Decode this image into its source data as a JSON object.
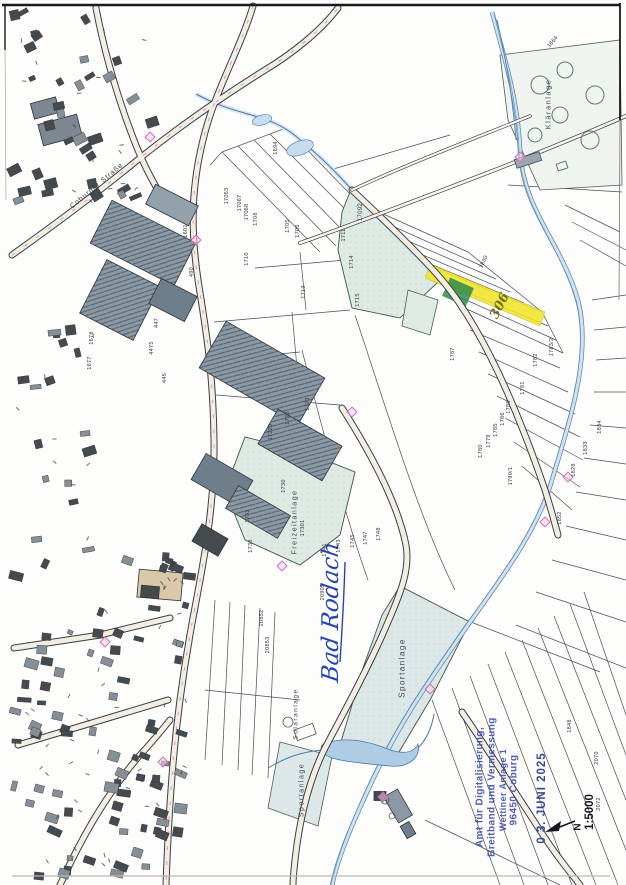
{
  "page": {
    "background": "#fdfdfc"
  },
  "stamp": {
    "office_lines": [
      "Amt für Digitalisierung,",
      "Breitband und Vermessung",
      "Wettiner Anlage 1",
      "96450 Coburg"
    ],
    "date_stamp": "0 3. JUNI 2025",
    "scale_label": "1:5000",
    "north_label": "N",
    "ink_color": "#4352b0"
  },
  "annotations": {
    "handwritten_place": "Bad Rodach",
    "handwritten_parcel": "306",
    "ink_color": "#2644b8",
    "highlight_color": "#f2e428",
    "marker_color": "#2e8b4f"
  },
  "labels": {
    "street": "Coburger Straße",
    "klaeranlage": "Kläranlage",
    "sportanlage_1": "Sportanlage",
    "freizeitanlage": "Freizeitanlage",
    "solaranlage": "Solaranlage",
    "sportanlage_2": "Sportanlage"
  },
  "parcel_numbers": [
    {
      "t": "1694",
      "x": 276,
      "y": 148
    },
    {
      "t": "1601",
      "x": 186,
      "y": 231
    },
    {
      "t": "17063",
      "x": 227,
      "y": 196
    },
    {
      "t": "17067",
      "x": 240,
      "y": 203
    },
    {
      "t": "17068",
      "x": 247,
      "y": 212
    },
    {
      "t": "1708",
      "x": 256,
      "y": 219
    },
    {
      "t": "1705",
      "x": 288,
      "y": 226
    },
    {
      "t": "1706",
      "x": 298,
      "y": 231
    },
    {
      "t": "1710",
      "x": 247,
      "y": 259
    },
    {
      "t": "1711",
      "x": 344,
      "y": 235
    },
    {
      "t": "1714",
      "x": 352,
      "y": 262
    },
    {
      "t": "1713",
      "x": 304,
      "y": 292
    },
    {
      "t": "1715",
      "x": 358,
      "y": 300
    },
    {
      "t": "17092",
      "x": 361,
      "y": 212,
      "s": 6
    },
    {
      "t": "490",
      "x": 192,
      "y": 272
    },
    {
      "t": "447",
      "x": 157,
      "y": 323
    },
    {
      "t": "4475",
      "x": 152,
      "y": 348
    },
    {
      "t": "445",
      "x": 165,
      "y": 378
    },
    {
      "t": "1678",
      "x": 92,
      "y": 338
    },
    {
      "t": "1677",
      "x": 90,
      "y": 363
    },
    {
      "t": "1722",
      "x": 288,
      "y": 418
    },
    {
      "t": "17220",
      "x": 271,
      "y": 432
    },
    {
      "t": "1723",
      "x": 308,
      "y": 404
    },
    {
      "t": "1730",
      "x": 284,
      "y": 486
    },
    {
      "t": "1731",
      "x": 248,
      "y": 516
    },
    {
      "t": "17301",
      "x": 303,
      "y": 528
    },
    {
      "t": "1738",
      "x": 251,
      "y": 546
    },
    {
      "t": "1741",
      "x": 325,
      "y": 550
    },
    {
      "t": "1743",
      "x": 339,
      "y": 546
    },
    {
      "t": "1745",
      "x": 353,
      "y": 541
    },
    {
      "t": "1747",
      "x": 366,
      "y": 538
    },
    {
      "t": "1748",
      "x": 379,
      "y": 534
    },
    {
      "t": "1830",
      "x": 484,
      "y": 262,
      "r": -65
    },
    {
      "t": "1664",
      "x": 553,
      "y": 42,
      "r": -50
    },
    {
      "t": "1787",
      "x": 453,
      "y": 354
    },
    {
      "t": "1783/2",
      "x": 552,
      "y": 347
    },
    {
      "t": "1782",
      "x": 536,
      "y": 360
    },
    {
      "t": "1781",
      "x": 523,
      "y": 388
    },
    {
      "t": "1788",
      "x": 509,
      "y": 407
    },
    {
      "t": "1786",
      "x": 503,
      "y": 419
    },
    {
      "t": "1785",
      "x": 496,
      "y": 430
    },
    {
      "t": "1779",
      "x": 489,
      "y": 441
    },
    {
      "t": "1780",
      "x": 481,
      "y": 451
    },
    {
      "t": "1790/1",
      "x": 511,
      "y": 476
    },
    {
      "t": "1834",
      "x": 600,
      "y": 427
    },
    {
      "t": "1833",
      "x": 586,
      "y": 448
    },
    {
      "t": "1828",
      "x": 574,
      "y": 470
    },
    {
      "t": "1852",
      "x": 560,
      "y": 518
    },
    {
      "t": "20902",
      "x": 323,
      "y": 592
    },
    {
      "t": "20852",
      "x": 262,
      "y": 618
    },
    {
      "t": "20853",
      "x": 268,
      "y": 645
    },
    {
      "t": "1848",
      "x": 570,
      "y": 726
    },
    {
      "t": "2070",
      "x": 597,
      "y": 758
    },
    {
      "t": "2072",
      "x": 599,
      "y": 804
    }
  ]
}
